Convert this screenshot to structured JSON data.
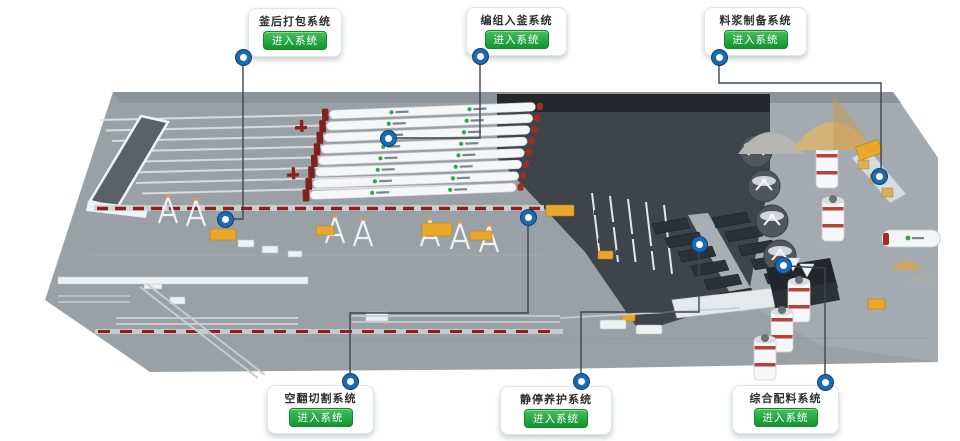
{
  "cards": [
    {
      "title": "釜后打包系统",
      "button_label": "进入系统"
    },
    {
      "title": "编组入釜系统",
      "button_label": "进入系统"
    },
    {
      "title": "料浆制备系统",
      "button_label": "进入系统"
    },
    {
      "title": "空翻切割系统",
      "button_label": "进入系统"
    },
    {
      "title": "静停养护系统",
      "button_label": "进入系统"
    },
    {
      "title": "综合配料系统",
      "button_label": "进入系统"
    }
  ],
  "colors": {
    "button_green": "#129431",
    "button_green_light": "#44bf5b",
    "marker_blue": "#1a6ab4",
    "marker_ring": "#123f6e",
    "connector_gray": "#3e454c",
    "floor_gray": "#9aa1a6",
    "platform_dark": "#3e444a",
    "autoclave_white": "#f4f6f8",
    "autoclave_door_red": "#7e221d",
    "logo_green": "#2fa84a",
    "sand_tan": "#d4b378",
    "sand_gray": "#b6b6b2",
    "machine_yellow": "#e9a72c"
  }
}
